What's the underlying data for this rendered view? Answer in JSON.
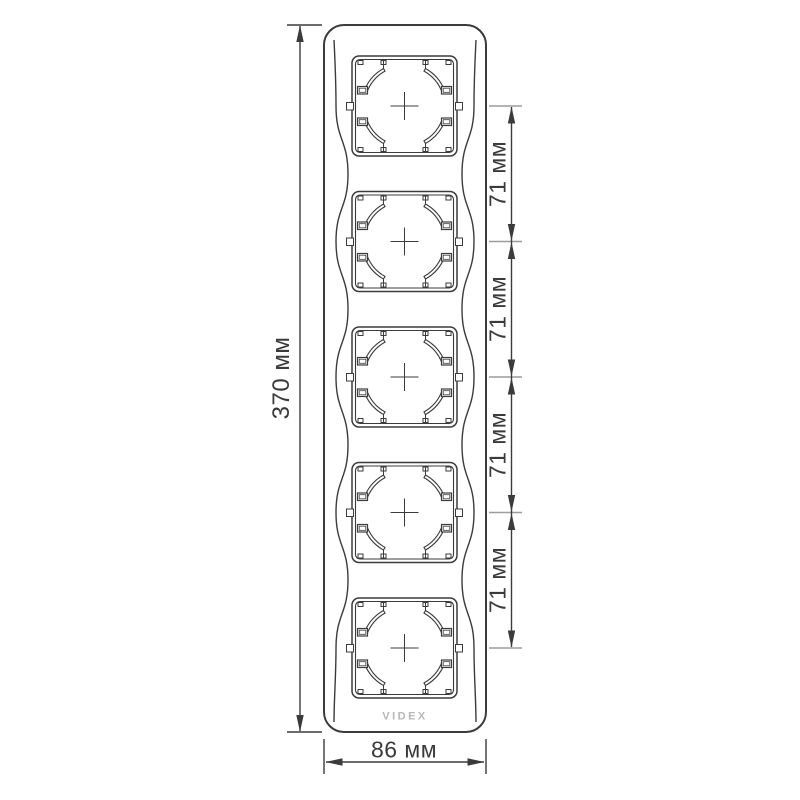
{
  "drawing": {
    "logo": "VIDEX",
    "socket_count": 5,
    "colors": {
      "line": "#3b3b3b",
      "tick": "#9c9c9c",
      "logo": "#b7b7b7",
      "background": "#ffffff",
      "text": "#3a3a3a"
    },
    "dimensions": {
      "overall_height": "370 мм",
      "overall_width": "86 мм",
      "spacing_labels": [
        "71 мм",
        "71 мм",
        "71 мм",
        "71 мм"
      ]
    }
  }
}
